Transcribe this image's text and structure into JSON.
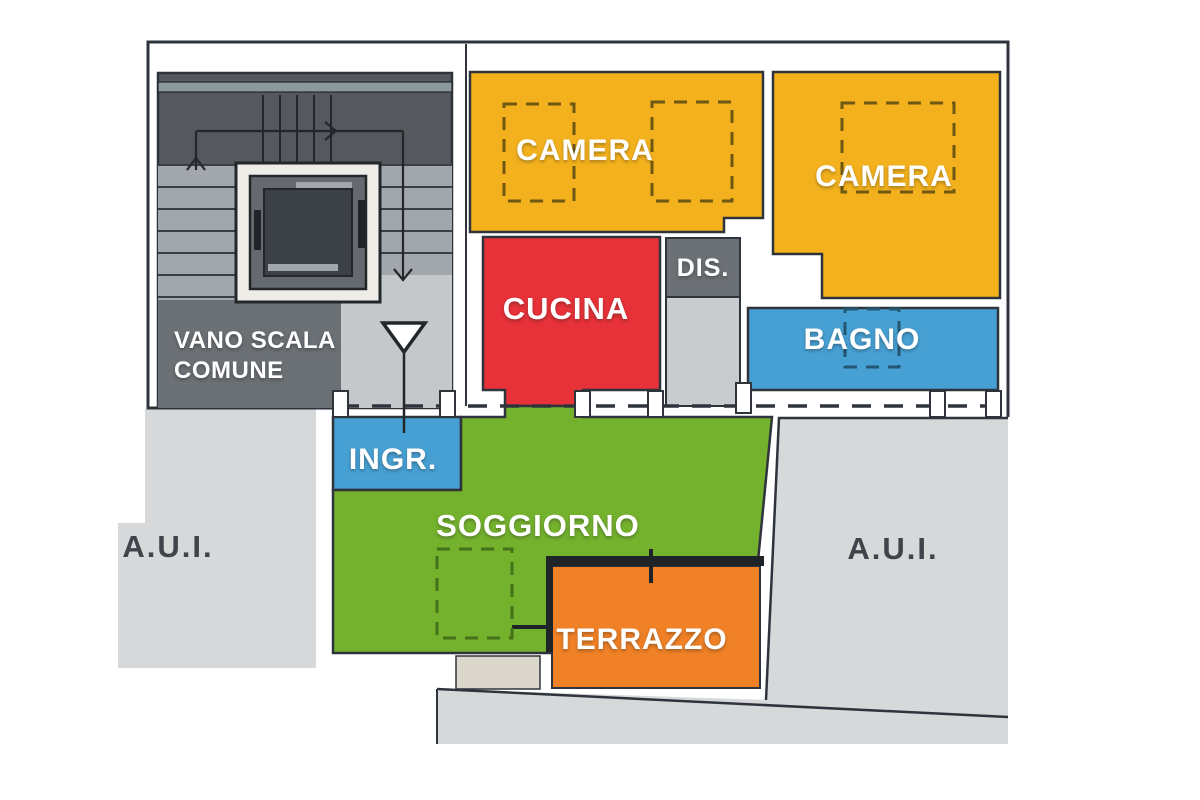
{
  "plan": {
    "type": "apartment floor plan",
    "rooms": {
      "stairwell": {
        "line1": "VANO SCALA",
        "line2": "COMUNE",
        "color": "#6B7075"
      },
      "camera_1": {
        "label": "CAMERA",
        "color": "#F3B11D"
      },
      "camera_2": {
        "label": "CAMERA",
        "color": "#F3B11D"
      },
      "disimpegno": {
        "label": "DIS.",
        "color": "#6B7075"
      },
      "cucina": {
        "label": "CUCINA",
        "color": "#E63238"
      },
      "bagno": {
        "label": "BAGNO",
        "color": "#47A0D3"
      },
      "ingresso": {
        "label": "INGR.",
        "color": "#47A0D3"
      },
      "soggiorno": {
        "label": "SOGGIORNO",
        "color": "#74B22E"
      },
      "terrazzo": {
        "label": "TERRAZZO",
        "color": "#F08126"
      },
      "aui_left": {
        "label": "A.U.I.",
        "color": "#D6D8DA"
      },
      "aui_right": {
        "label": "A.U.I.",
        "color": "#D6D8DA"
      }
    },
    "colors": {
      "outline": "#2F343C",
      "parapet": "#1F2428",
      "stair_dark": "#55595E",
      "stair_stripe": "#8A999E",
      "stair_steps": "#A2A7AB",
      "stair_landing": "#C5C8CB",
      "corridor": "#C9CCCE",
      "elevator_frame": "#EFEDE8",
      "beige_sill": "#DBD7CC",
      "room_label_text": "#FFFFFF",
      "aui_label_text": "#3F444A"
    }
  }
}
